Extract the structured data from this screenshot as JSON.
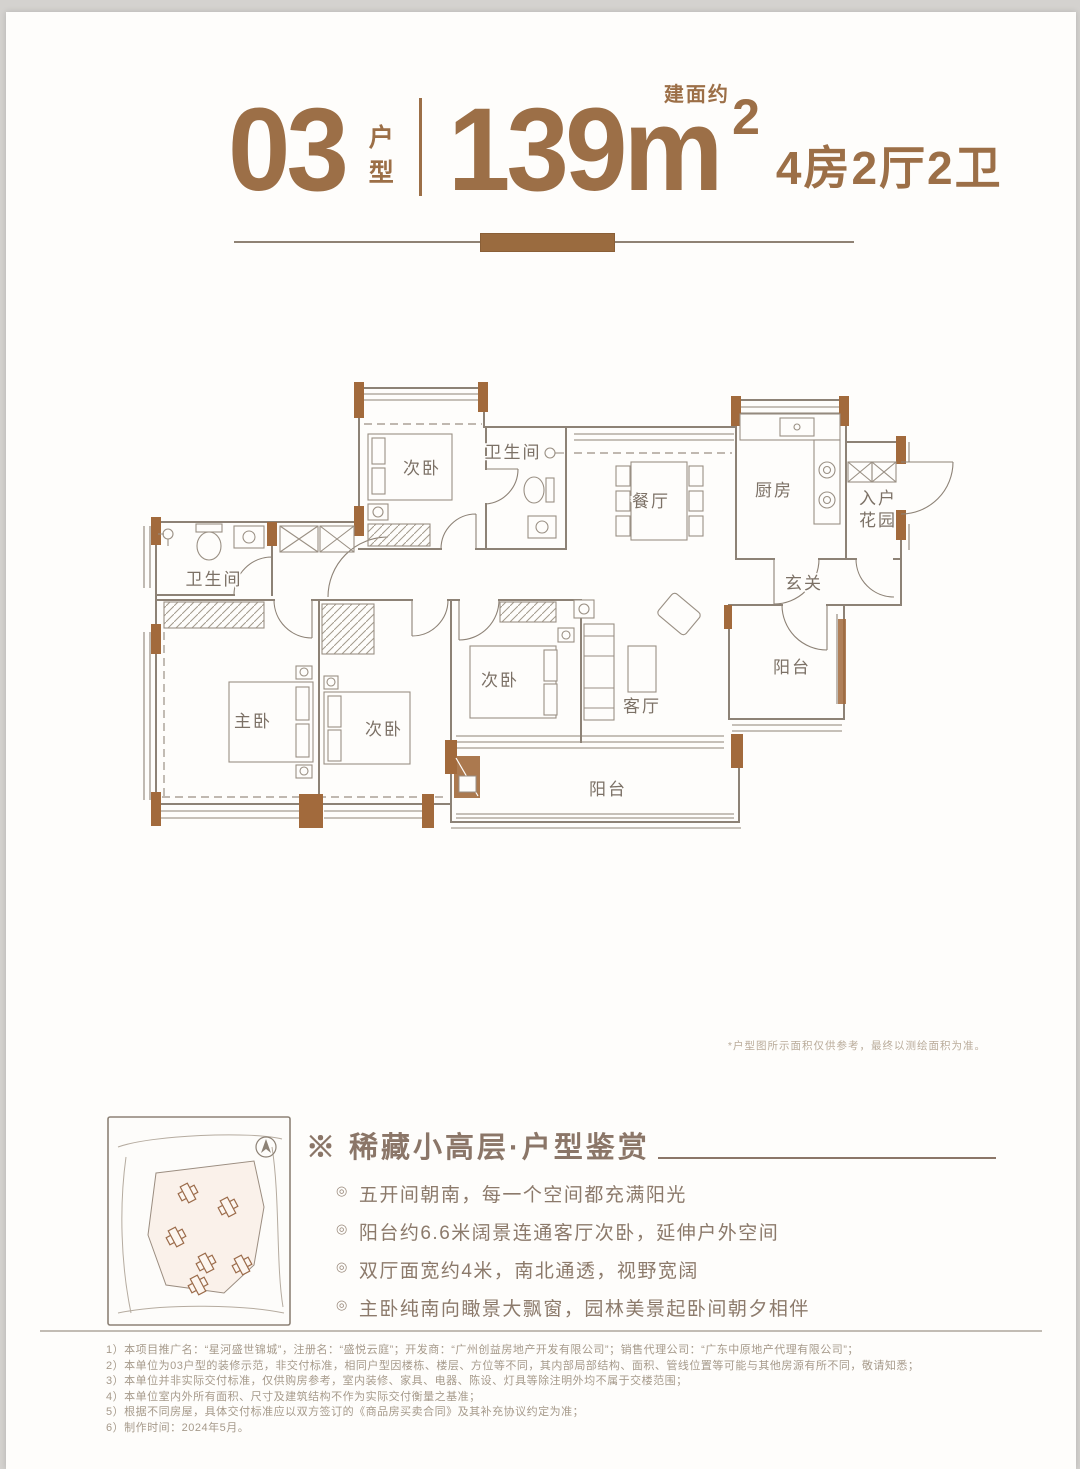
{
  "colors": {
    "accent": "#9c6f47",
    "wall": "#a26a3c",
    "line": "#8d8276",
    "plan_text": "#7c7166",
    "bullet_text": "#8c7a6b",
    "footer_text": "#a69a8b",
    "note_text": "#b9ab9a"
  },
  "header": {
    "unit_no": "03",
    "unit_label": "户型",
    "area_value": "139m",
    "area_sup": "2",
    "area_note": "建面约",
    "layout_desc": "4房2厅2卫"
  },
  "plan": {
    "note": "*户型图所示面积仅供参考，最终以测绘面积为准。",
    "rooms": {
      "bedroom_top": "次卧",
      "bath_top": "卫生间",
      "dining": "餐厅",
      "kitchen": "厨房",
      "entry_garden_1": "入户",
      "entry_garden_2": "花园",
      "foyer": "玄关",
      "bath_left": "卫生间",
      "master": "主卧",
      "bedroom_mid": "次卧",
      "bedroom_right": "次卧",
      "living": "客厅",
      "balcony_right": "阳台",
      "balcony_bottom": "阳台"
    }
  },
  "highlights": {
    "title": "※ 稀藏小高层·户型鉴赏",
    "marker": "◎",
    "bullets": [
      "五开间朝南，每一个空间都充满阳光",
      "阳台约6.6米阔景连通客厅次卧，延伸户外空间",
      "双厅面宽约4米，南北通透，视野宽阔",
      "主卧纯南向瞰景大飘窗，园林美景起卧间朝夕相伴"
    ]
  },
  "footer": {
    "lines": [
      "1）本项目推广名：“星河盛世锦城”，注册名：“盛悦云庭”；开发商：“广州创益房地产开发有限公司”；销售代理公司：“广东中原地产代理有限公司”；",
      "2）本单位为03户型的装修示范，非交付标准，相同户型因楼栋、楼层、方位等不同，其内部局部结构、面积、管线位置等可能与其他房源有所不同，敬请知悉；",
      "3）本单位并非实际交付标准，仅供购房参考，室内装修、家具、电器、陈设、灯具等除注明外均不属于交楼范围；",
      "4）本单位室内外所有面积、尺寸及建筑结构不作为实际交付衡量之基准；",
      "5）根据不同房屋，具体交付标准应以双方签订的《商品房买卖合同》及其补充协议约定为准；",
      "6）制作时间：2024年5月。"
    ]
  }
}
